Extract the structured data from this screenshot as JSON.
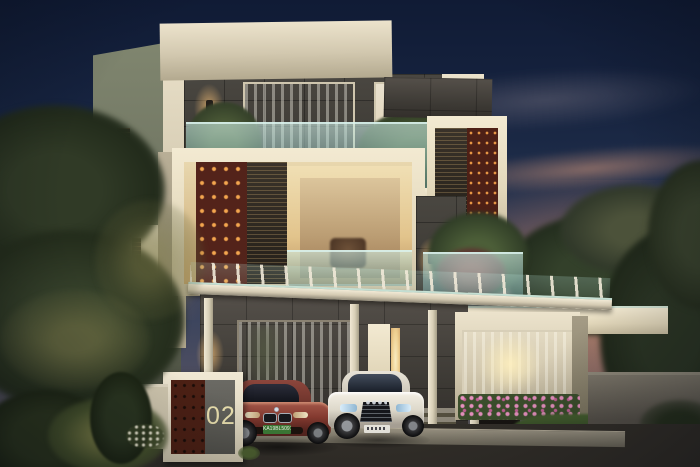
{
  "meta": {
    "title": "Modern villa exterior — dusk architectural rendering"
  },
  "scene": {
    "setting": "dusk",
    "description": "Three-storey modern villa with white box volumes, dark grey stone cladding, rust perforated screens with glowing cutouts, wood louver panels, glass balconies with planters, pergola carport with two parked cars, gate pillar numbered 02, landscaped garden and paved driveway",
    "house_number": "02"
  },
  "vehicles": {
    "left_car": {
      "body": "maroon coupe",
      "plate": "KA19BL5091",
      "plate_color": "#3c7a36"
    },
    "right_car": {
      "body": "white sedan",
      "plate": "",
      "plate_color": "#e9e7df"
    }
  },
  "palette": {
    "sky_top": "#101b35",
    "sky_mid": "#23324f",
    "sunset_cloud": "#d4937a",
    "wall_cream_lit": "#ece3cc",
    "wall_side_shade": "#6d7260",
    "stone_dark": "#3b3833",
    "screen_rust": "#53231a",
    "screen_glow": "#f4a64f",
    "glass_teal": "#9fd8d2",
    "window_warm": "#f6e3ae",
    "foliage_dark": "#26301f",
    "driveway": "#34312c",
    "lawn": "#3f5a2e",
    "flowers_pink": "#d678aa"
  }
}
